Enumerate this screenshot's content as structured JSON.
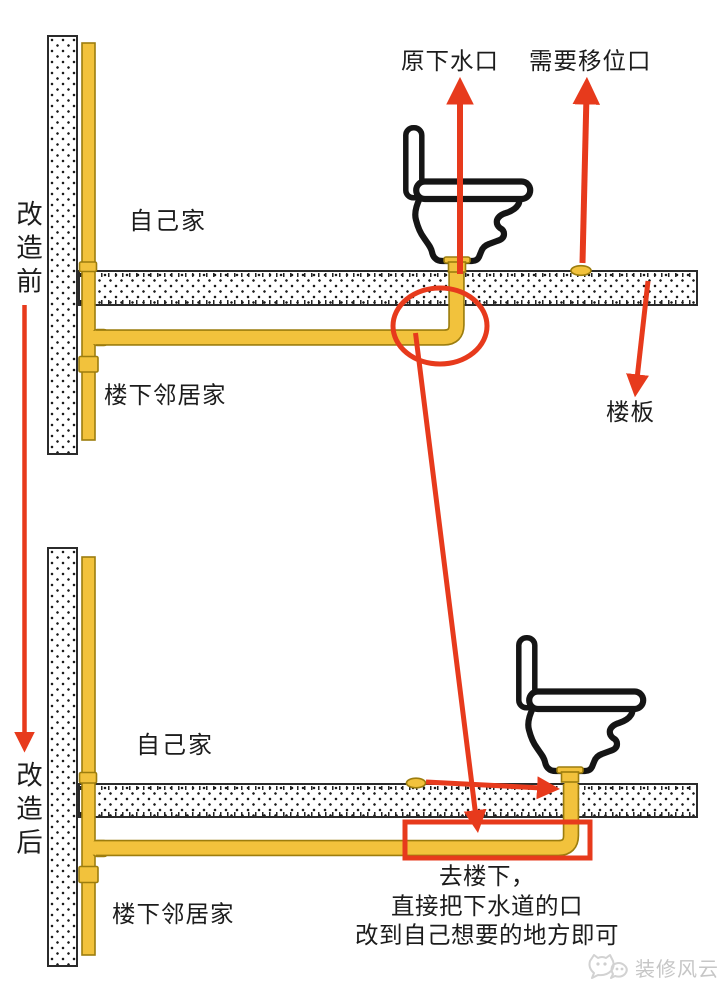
{
  "labels": {
    "before": "改造前",
    "after": "改造后",
    "original_drain": "原下水口",
    "relocation_port": "需要移位口",
    "floor_slab": "楼板",
    "own_home_before": "自己家",
    "downstairs_neighbor_before": "楼下邻居家",
    "own_home_after": "自己家",
    "downstairs_neighbor_after": "楼下邻居家"
  },
  "caption": {
    "line1": "去楼下，",
    "line2": "直接把下水道的口",
    "line3": "改到自己想要的地方即可"
  },
  "watermark": {
    "text": "装修风云"
  },
  "colors": {
    "pipe_yellow": "#F2C23C",
    "pipe_border": "#9C7D0E",
    "annotation_red": "#E73A1C",
    "outline_black": "#151515",
    "concrete_border": "#2B2B2B",
    "watermark_gray": "#C6C6C6"
  }
}
